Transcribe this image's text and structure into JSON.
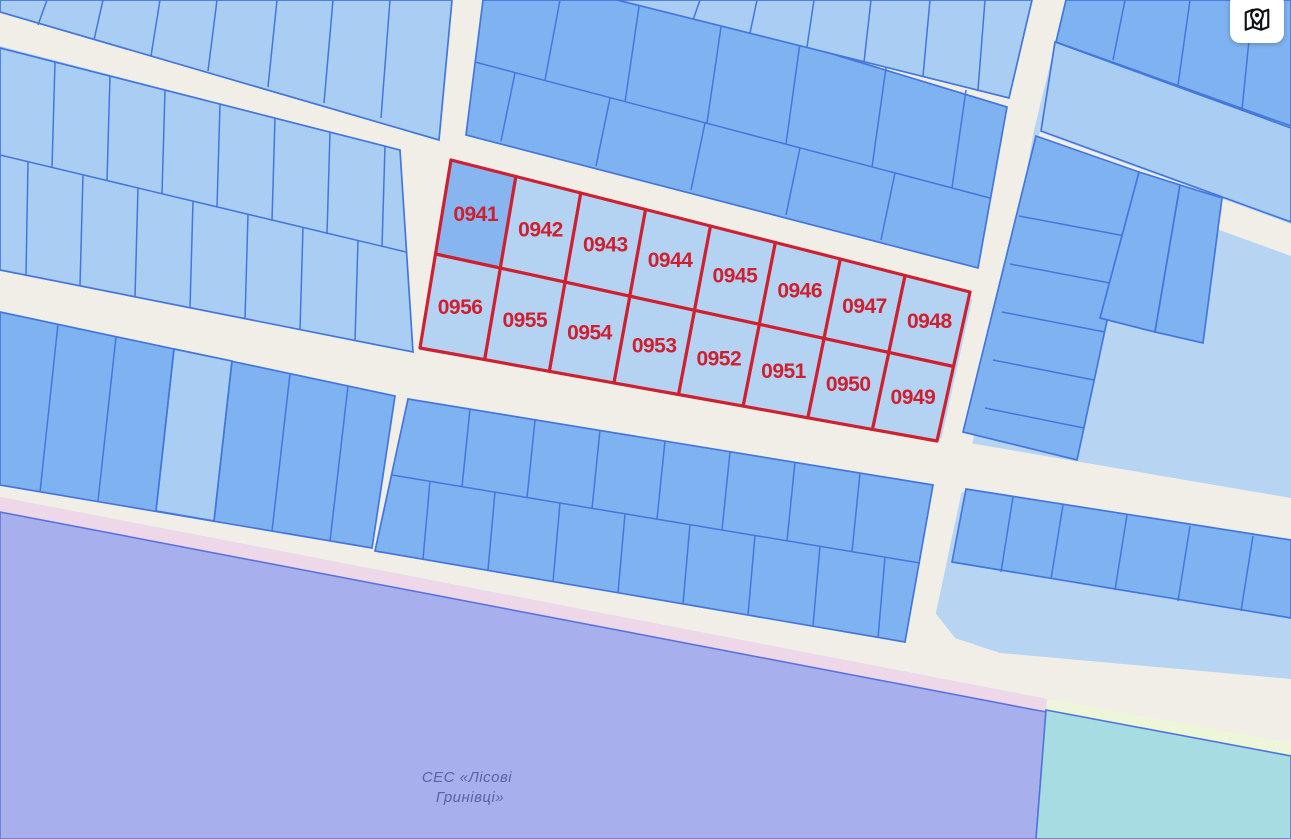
{
  "map": {
    "button": {
      "icon": "map-pin-icon"
    },
    "area_label": {
      "line1": "СЕС «Лісові",
      "line2": "Гринівці»"
    },
    "selected_block": {
      "rows": 2,
      "cols": 8,
      "parcels": [
        {
          "label": "0941",
          "row": 0,
          "col": 0,
          "highlighted": true
        },
        {
          "label": "0942",
          "row": 0,
          "col": 1
        },
        {
          "label": "0943",
          "row": 0,
          "col": 2
        },
        {
          "label": "0944",
          "row": 0,
          "col": 3
        },
        {
          "label": "0945",
          "row": 0,
          "col": 4
        },
        {
          "label": "0946",
          "row": 0,
          "col": 5
        },
        {
          "label": "0947",
          "row": 0,
          "col": 6
        },
        {
          "label": "0948",
          "row": 0,
          "col": 7
        },
        {
          "label": "0949",
          "row": 1,
          "col": 7
        },
        {
          "label": "0950",
          "row": 1,
          "col": 6
        },
        {
          "label": "0951",
          "row": 1,
          "col": 5
        },
        {
          "label": "0952",
          "row": 1,
          "col": 4
        },
        {
          "label": "0953",
          "row": 1,
          "col": 3
        },
        {
          "label": "0954",
          "row": 1,
          "col": 2
        },
        {
          "label": "0955",
          "row": 1,
          "col": 1
        },
        {
          "label": "0956",
          "row": 1,
          "col": 0
        }
      ]
    }
  },
  "colors": {
    "road": "#f0eee6",
    "base": "#b7d5f3",
    "parcelLight": "#a9cdf3",
    "parcelMedium": "#7fb2f0",
    "line": "#4377de",
    "selected": "#cf2030",
    "selectedFill": "#b4d3f3",
    "selectedHighlight": "#86b5f0",
    "zonePurple": "#a7afec",
    "zonePurpleBorder": "#5b74dd",
    "zonePink": "#eed7e8",
    "zoneYellow": "#eef6da",
    "zoneCyan": "#a6dce2",
    "zoneCyanBorder": "#4f75dd",
    "zoneLabel": "#5c63a3"
  }
}
